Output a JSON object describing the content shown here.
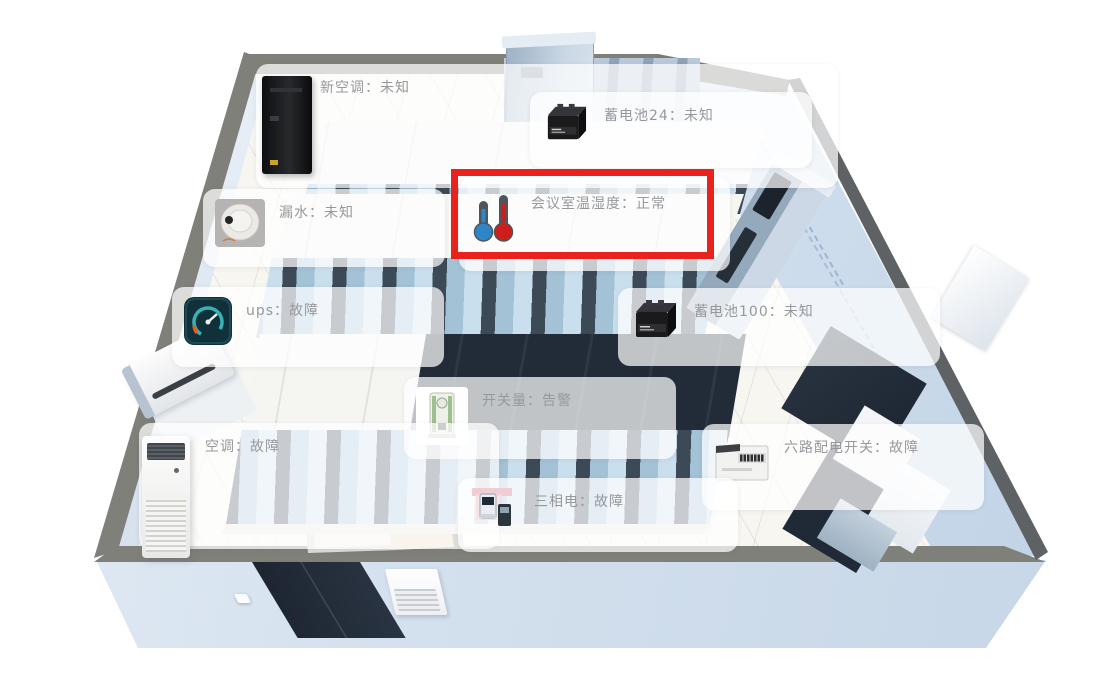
{
  "view": {
    "kind": "机房3D监控视图",
    "room_labels_count": 10
  },
  "markers": [
    {
      "id": "new-ac",
      "device": "新空调",
      "status": "未知",
      "label": "新空调：未知",
      "icon": "tower-ac-image"
    },
    {
      "id": "battery-24",
      "device": "蓄电池24",
      "status": "未知",
      "label": "蓄电池24：未知",
      "icon": "battery-image"
    },
    {
      "id": "meeting-room-th",
      "device": "会议室温湿度",
      "status": "正常",
      "label": "会议室温湿度：正常",
      "icon": "thermometer-icon",
      "highlighted": true
    },
    {
      "id": "water-leak",
      "device": "漏水",
      "status": "未知",
      "label": "漏水：未知",
      "icon": "leak-detector-image"
    },
    {
      "id": "ups",
      "device": "ups",
      "status": "故障",
      "label": "ups：故障",
      "icon": "gauge-icon"
    },
    {
      "id": "battery-100",
      "device": "蓄电池100",
      "status": "未知",
      "label": "蓄电池100：未知",
      "icon": "battery-image"
    },
    {
      "id": "digital-io",
      "device": "开关量",
      "status": "告警",
      "label": "开关量：告警",
      "icon": "io-module-image"
    },
    {
      "id": "air-conditioner",
      "device": "空调",
      "status": "故障",
      "label": "空调：故障",
      "icon": "floor-ac-model"
    },
    {
      "id": "six-way-switch",
      "device": "六路配电开关",
      "status": "故障",
      "label": "六路配电开关：故障",
      "icon": "distribution-box-image"
    },
    {
      "id": "three-phase",
      "device": "三相电",
      "status": "故障",
      "label": "三相电：故障",
      "icon": "power-meter-image"
    }
  ],
  "highlight": {
    "marker": "会议室温湿度",
    "border_color": "#e8231d"
  },
  "colors": {
    "wall_band": "#80807a",
    "wall_face_light": "#eaf1f9",
    "wall_face_dark": "#c7d6e6",
    "floor": "#f7f6f1",
    "rack_glass": "#a8c6da",
    "rack_frame": "#3c4956",
    "aisle_roof": "#232c39",
    "label_background": "rgba(255,255,255,0.72)",
    "label_text": "#97989c"
  }
}
